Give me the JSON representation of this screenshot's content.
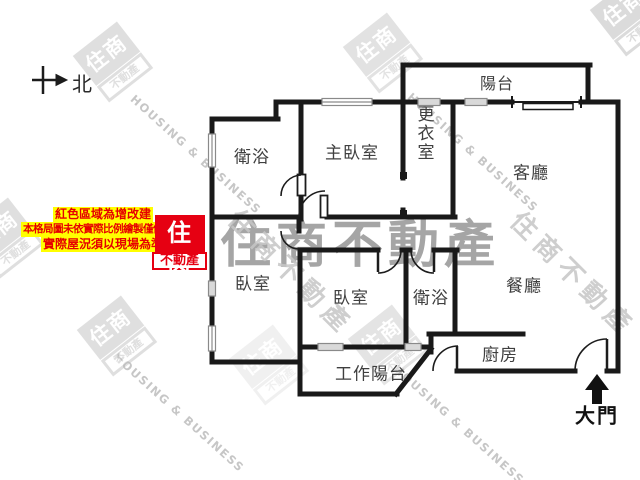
{
  "compass": {
    "label": "北"
  },
  "notice": {
    "lines": [
      "紅色區域為增改建",
      "本格局圖未依實際比例繪製僅供參考",
      "實際屋況須以現場為準"
    ],
    "text_color": "#e60000",
    "bg_color": "#ffff00"
  },
  "brand": {
    "logo_top": "住商",
    "logo_bottom": "不動產",
    "red": "#e60012"
  },
  "watermarks": {
    "center_text": "住商不動產",
    "diagonal_cjk": "住商不動產",
    "diagonal_eng": "HOUSING & BUSINESS",
    "stamp_top": "住商",
    "stamp_bottom": "不動產"
  },
  "rooms": [
    {
      "id": "balcony",
      "label": "陽台"
    },
    {
      "id": "bathroom-1",
      "label": "衛浴"
    },
    {
      "id": "master-bedroom",
      "label": "主臥室"
    },
    {
      "id": "dressing-room",
      "label": "更衣室"
    },
    {
      "id": "living-room",
      "label": "客廳"
    },
    {
      "id": "bedroom-2",
      "label": "臥室"
    },
    {
      "id": "bedroom-3",
      "label": "臥室"
    },
    {
      "id": "bathroom-2",
      "label": "衛浴"
    },
    {
      "id": "dining-room",
      "label": "餐廳"
    },
    {
      "id": "kitchen",
      "label": "廚房"
    },
    {
      "id": "work-balcony",
      "label": "工作陽台"
    }
  ],
  "entrance": {
    "label": "大門"
  }
}
